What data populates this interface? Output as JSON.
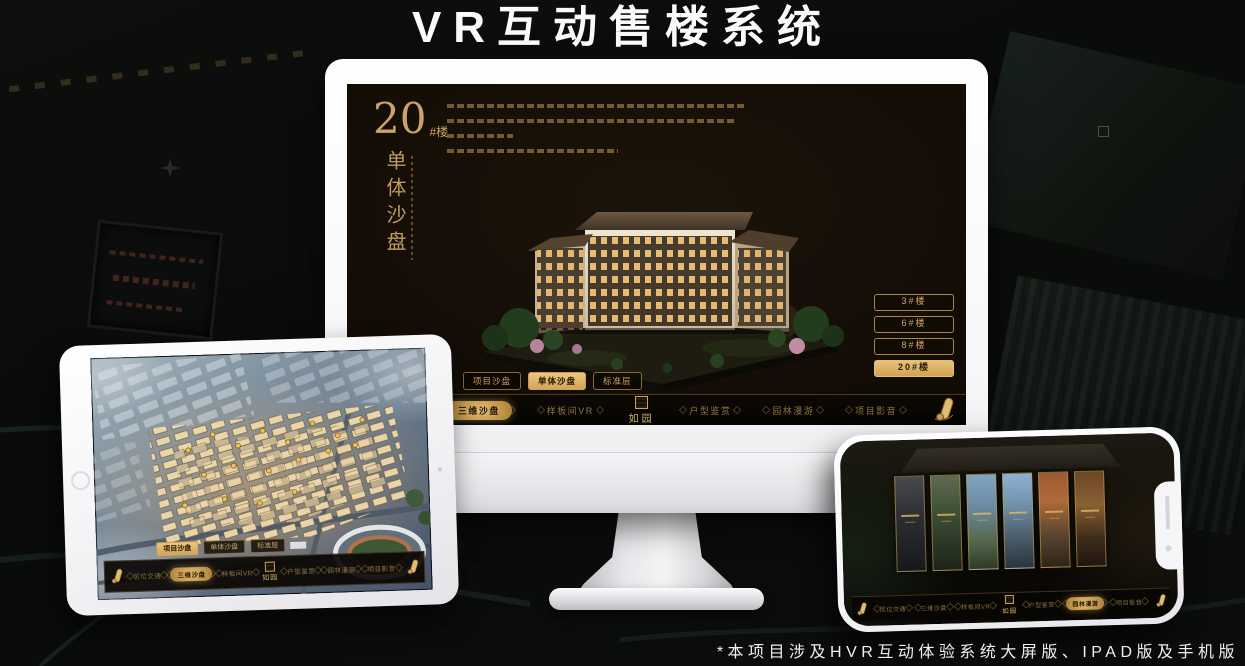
{
  "page": {
    "title": "VR互动售楼系统",
    "footer_note": "*本项目涉及HVR互动体验系统大屏版、IPAD版及手机版"
  },
  "colors": {
    "gold": "#d4ab62",
    "gold_text": "#c8a25f",
    "active_pill": "#d9b267",
    "screen_bg": "#14100a"
  },
  "desktop": {
    "heading": {
      "number": "20",
      "suffix": "#楼",
      "vertical_title": "单体沙盘"
    },
    "floor_buttons": [
      "3#楼",
      "6#楼",
      "8#楼",
      "20#楼"
    ],
    "active_floor": "20#楼",
    "sub_tabs": [
      "项目沙盘",
      "单体沙盘",
      "标准层"
    ],
    "active_sub_tab": "单体沙盘",
    "nav": [
      "区位交通",
      "三维沙盘",
      "样板间VR",
      "户型鉴赏",
      "园林漫游",
      "项目影音"
    ],
    "active_nav": "三维沙盘",
    "logo": "如园"
  },
  "ipad": {
    "sub_tabs": [
      "项目沙盘",
      "单体沙盘",
      "标准层"
    ],
    "active_sub_tab": "项目沙盘",
    "nav": [
      "区位交通",
      "三维沙盘",
      "样板间VR",
      "户型鉴赏",
      "园林漫游",
      "项目影音"
    ],
    "active_nav": "三维沙盘",
    "logo": "如园"
  },
  "phone": {
    "nav": [
      "区位交通",
      "三维沙盘",
      "样板间VR",
      "户型鉴赏",
      "园林漫游",
      "项目影音"
    ],
    "active_nav": "园林漫游",
    "logo": "如园"
  }
}
